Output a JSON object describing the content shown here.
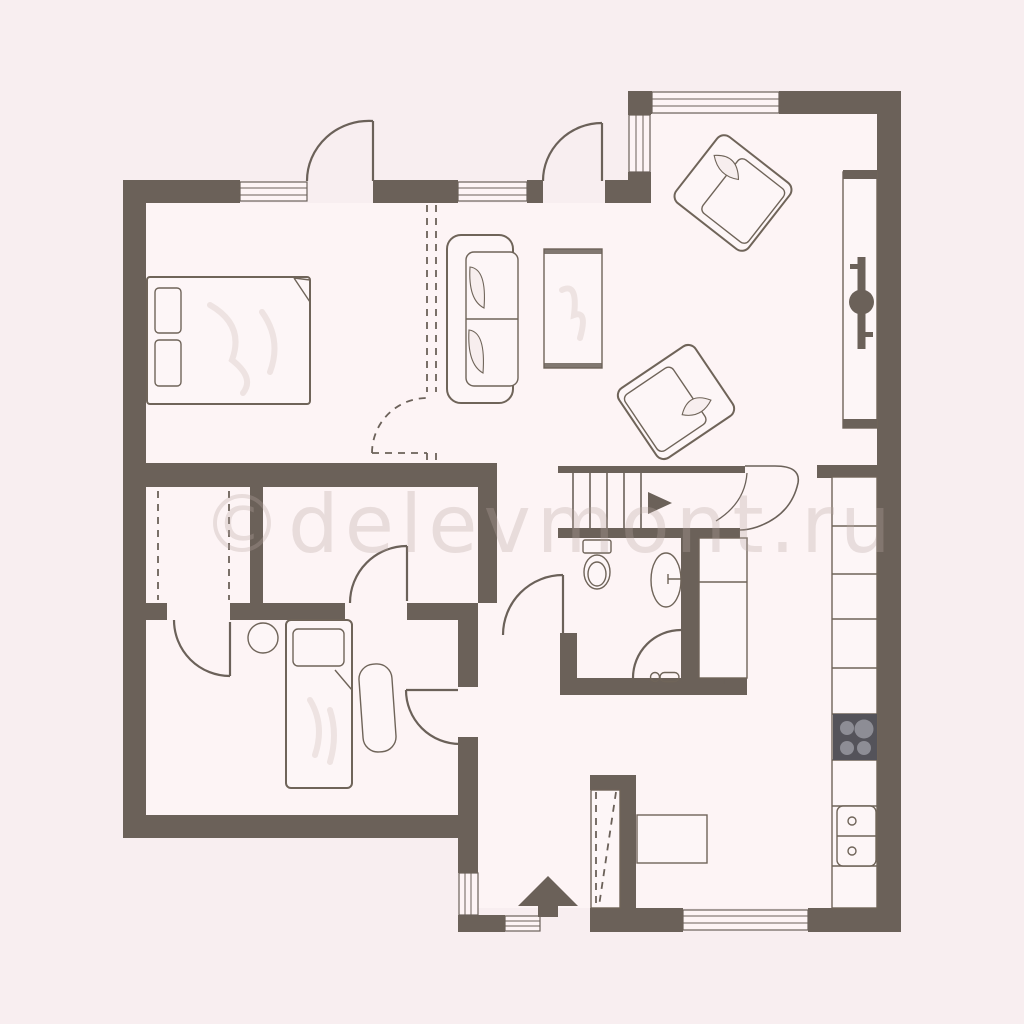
{
  "watermark": {
    "text": "©delevmont.ru"
  },
  "colors": {
    "background": "#f8eef0",
    "floor": "#fdf4f5",
    "wall": "#6b6159",
    "furniture_fill": "#fdf6f7",
    "furniture_stroke": "#6f6459",
    "pillow_fill": "#f7eeee",
    "soft_shade": "#eadedc",
    "stove_base": "#54535a",
    "stove_burner": "#8d8d95",
    "watermark_color": "#b9a7a2"
  },
  "symbols": {
    "entrance_arrow": "filled triangle pointing up into plan",
    "stairs_arrow": "filled triangle pointing right (direction up)",
    "door": "quarter-circle swing arc with leaf line",
    "window": "white wall gap with double frame lines",
    "dashed_partition": "optional/removed wall with dashed door swing",
    "shower": "corner quarter-circle screen with handle glyph",
    "wardrobe_dash": "dashed hanging-rod line"
  }
}
